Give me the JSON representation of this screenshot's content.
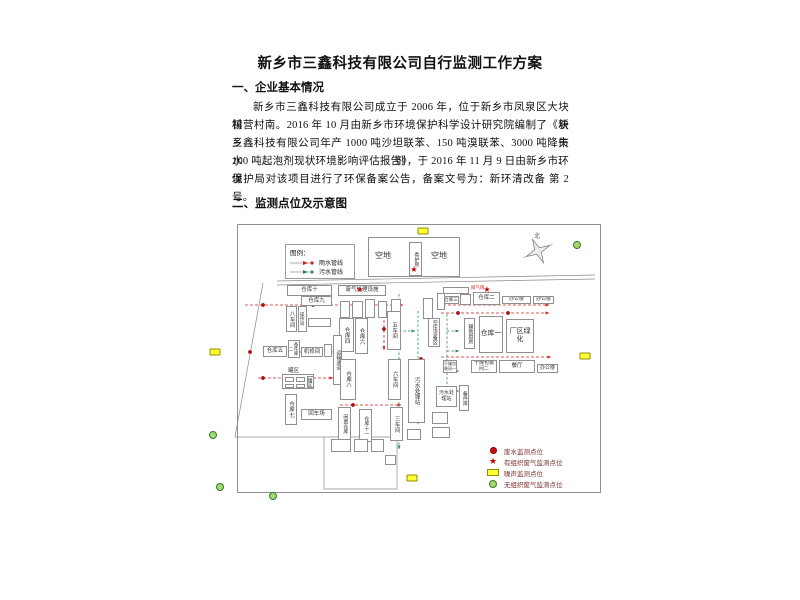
{
  "document": {
    "title": "新乡市三鑫科技有限公司自行监测工作方案",
    "section1_heading": "一、企业基本情况",
    "paragraph_lines": [
      "新乡市三鑫科技有限公司成立于 2006 年，位于新乡市凤泉区大块镇块",
      "村营村南。2016 年 10 月由新乡市环境保护科学设计研究院编制了《新乡市",
      "三鑫科技有限公司年产 1000 吨沙坦联苯、150 吨溴联苯、3000 吨降失水剂、",
      "100 吨起泡剂现状环境影响评估报告》，于 2016 年 11 月 9 日由新乡市环境",
      "保护局对该项目进行了环保备案公告，备案文号为：新环清改备 第 2 号。"
    ],
    "section2_heading": "二、监测点位及示意图"
  },
  "map": {
    "compass_label": "北",
    "star_char": "★",
    "colors": {
      "rain_line": "#cc2222",
      "sewage_line": "#2e8b57",
      "noise_fill": "#ffff33",
      "noise_border": "#8f8f00",
      "gas_fill": "#a6d96a",
      "gas_border": "#2e7d32",
      "star": "#cc0000",
      "dot": "#bb1111",
      "legend_text": "#7a2e2e"
    },
    "legend_pipes": {
      "title": "图例：",
      "items": [
        {
          "label": "雨水管线",
          "color": "#cc2222"
        },
        {
          "label": "污水管线",
          "color": "#2e8b57"
        }
      ]
    },
    "legend_points": [
      {
        "symbol": "dot",
        "label": "废水监测点位"
      },
      {
        "symbol": "star",
        "label": "有组织废气监测点位"
      },
      {
        "symbol": "noise",
        "label": "噪声监测点位"
      },
      {
        "symbol": "gas",
        "label": "无组织废气监测点位"
      }
    ],
    "buildings": [
      {
        "label": "",
        "x": 165,
        "y": 18,
        "w": 92,
        "h": 40
      },
      {
        "label": "看护房",
        "x": 206,
        "y": 23,
        "w": 13,
        "h": 34,
        "v": 1,
        "fs": 5
      },
      {
        "label": "仓库十",
        "x": 84,
        "y": 66,
        "w": 45,
        "h": 11
      },
      {
        "label": "仓库九",
        "x": 98,
        "y": 77,
        "w": 31,
        "h": 10
      },
      {
        "label": "八车间",
        "x": 83,
        "y": 87,
        "w": 11,
        "h": 26,
        "v": 1
      },
      {
        "label": "操作间",
        "x": 95,
        "y": 87,
        "w": 9,
        "h": 26,
        "v": 1,
        "fs": 4.5
      },
      {
        "label": "",
        "x": 105,
        "y": 99,
        "w": 23,
        "h": 9
      },
      {
        "label": "废气处理设施",
        "x": 135,
        "y": 66,
        "w": 48,
        "h": 11
      },
      {
        "label": "",
        "x": 240,
        "y": 68,
        "w": 26,
        "h": 7
      },
      {
        "label": "仓库三",
        "x": 240,
        "y": 77,
        "w": 16,
        "h": 8,
        "fs": 4.5
      },
      {
        "label": "",
        "x": 257,
        "y": 75,
        "w": 11,
        "h": 11
      },
      {
        "label": "仓库二",
        "x": 270,
        "y": 73,
        "w": 27,
        "h": 13
      },
      {
        "label": "办公楼",
        "x": 299,
        "y": 77,
        "w": 29,
        "h": 8,
        "fs": 5
      },
      {
        "label": "办公楼",
        "x": 330,
        "y": 77,
        "w": 21,
        "h": 8,
        "fs": 5
      },
      {
        "label": "",
        "x": 137,
        "y": 82,
        "w": 10,
        "h": 17
      },
      {
        "label": "",
        "x": 149,
        "y": 82,
        "w": 11,
        "h": 17
      },
      {
        "label": "",
        "x": 162,
        "y": 80,
        "w": 10,
        "h": 19
      },
      {
        "label": "",
        "x": 175,
        "y": 82,
        "w": 9,
        "h": 17
      },
      {
        "label": "",
        "x": 188,
        "y": 80,
        "w": 10,
        "h": 19
      },
      {
        "label": "",
        "x": 220,
        "y": 79,
        "w": 10,
        "h": 21
      },
      {
        "label": "",
        "x": 234,
        "y": 74,
        "w": 8,
        "h": 17
      },
      {
        "label": "仓库四",
        "x": 136,
        "y": 99,
        "w": 15,
        "h": 34,
        "v": 1
      },
      {
        "label": "仓库六",
        "x": 152,
        "y": 99,
        "w": 13,
        "h": 36,
        "v": 1
      },
      {
        "label": "五车间",
        "x": 184,
        "y": 92,
        "w": 14,
        "h": 39,
        "v": 1
      },
      {
        "label": "空压设备区",
        "x": 225,
        "y": 99,
        "w": 12,
        "h": 29,
        "v": 1,
        "fs": 5
      },
      {
        "label": "辅助用房",
        "x": 261,
        "y": 99,
        "w": 11,
        "h": 31,
        "v": 1,
        "fs": 5
      },
      {
        "label": "仓库一",
        "x": 276,
        "y": 97,
        "w": 24,
        "h": 37,
        "fs": 7
      },
      {
        "label": "厂区绿化",
        "x": 303,
        "y": 100,
        "w": 28,
        "h": 34,
        "fs": 7
      },
      {
        "label": "仓库五",
        "x": 60,
        "y": 127,
        "w": 24,
        "h": 11
      },
      {
        "label": "备件库二",
        "x": 85,
        "y": 121,
        "w": 12,
        "h": 18,
        "v": 1,
        "fs": 4.5
      },
      {
        "label": "机修间",
        "x": 98,
        "y": 128,
        "w": 22,
        "h": 10
      },
      {
        "label": "",
        "x": 121,
        "y": 125,
        "w": 8,
        "h": 13
      },
      {
        "label": "运输通道",
        "x": 130,
        "y": 116,
        "w": 9,
        "h": 50,
        "v": 1,
        "fs": 5
      },
      {
        "label": "",
        "x": 79,
        "y": 155,
        "w": 32,
        "h": 15
      },
      {
        "label": "",
        "x": 82,
        "y": 158,
        "w": 9,
        "h": 5
      },
      {
        "label": "",
        "x": 93,
        "y": 158,
        "w": 9,
        "h": 5
      },
      {
        "label": "",
        "x": 82,
        "y": 165,
        "w": 9,
        "h": 4
      },
      {
        "label": "",
        "x": 93,
        "y": 165,
        "w": 9,
        "h": 4
      },
      {
        "label": "罐区",
        "x": 104,
        "y": 157,
        "w": 7,
        "h": 12,
        "v": 1,
        "fs": 4.5
      },
      {
        "label": "仓库八",
        "x": 137,
        "y": 140,
        "w": 16,
        "h": 41,
        "v": 1
      },
      {
        "label": "六车间",
        "x": 185,
        "y": 140,
        "w": 13,
        "h": 41,
        "v": 1
      },
      {
        "label": "污水处理站",
        "x": 205,
        "y": 140,
        "w": 17,
        "h": 64,
        "v": 1
      },
      {
        "label": "仓库七",
        "x": 82,
        "y": 175,
        "w": 12,
        "h": 31,
        "v": 1
      },
      {
        "label": "回车场",
        "x": 98,
        "y": 190,
        "w": 31,
        "h": 11
      },
      {
        "label": "闲置仓库",
        "x": 135,
        "y": 188,
        "w": 13,
        "h": 33,
        "v": 1,
        "fs": 5
      },
      {
        "label": "仓库十一",
        "x": 156,
        "y": 190,
        "w": 13,
        "h": 33,
        "v": 1,
        "fs": 5
      },
      {
        "label": "三车间",
        "x": 187,
        "y": 188,
        "w": 13,
        "h": 34,
        "v": 1
      },
      {
        "label": "污水处理站",
        "x": 233,
        "y": 167,
        "w": 21,
        "h": 21,
        "fs": 5
      },
      {
        "label": "备件库",
        "x": 256,
        "y": 166,
        "w": 10,
        "h": 26,
        "v": 1,
        "fs": 5
      },
      {
        "label": "干燥包装间一",
        "x": 240,
        "y": 141,
        "w": 14,
        "h": 13,
        "fs": 4
      },
      {
        "label": "干燥包装间二",
        "x": 268,
        "y": 141,
        "w": 26,
        "h": 13,
        "fs": 5
      },
      {
        "label": "餐厅",
        "x": 296,
        "y": 141,
        "w": 36,
        "h": 13
      },
      {
        "label": "办公楼",
        "x": 334,
        "y": 145,
        "w": 21,
        "h": 9,
        "fs": 5
      },
      {
        "label": "",
        "x": 229,
        "y": 193,
        "w": 16,
        "h": 12
      },
      {
        "label": "",
        "x": 229,
        "y": 208,
        "w": 18,
        "h": 11
      },
      {
        "label": "",
        "x": 204,
        "y": 210,
        "w": 14,
        "h": 11
      },
      {
        "label": "",
        "x": 128,
        "y": 220,
        "w": 20,
        "h": 13
      },
      {
        "label": "",
        "x": 151,
        "y": 220,
        "w": 14,
        "h": 13
      },
      {
        "label": "",
        "x": 168,
        "y": 220,
        "w": 13,
        "h": 13
      },
      {
        "label": "",
        "x": 182,
        "y": 236,
        "w": 11,
        "h": 10
      }
    ],
    "texts": [
      {
        "t": "空地",
        "x": 172,
        "y": 31,
        "size": 8
      },
      {
        "t": "空地",
        "x": 228,
        "y": 31,
        "size": 8
      },
      {
        "t": "罐区",
        "x": 85,
        "y": 147,
        "size": 5.5
      },
      {
        "t": "排气筒",
        "x": 268,
        "y": 66,
        "size": 4.5,
        "color": "#cc2222"
      }
    ],
    "points": {
      "stars": [
        [
          157,
          71
        ],
        [
          211,
          51
        ],
        [
          284,
          71
        ]
      ],
      "dots": [
        [
          60,
          86
        ],
        [
          110,
          86
        ],
        [
          155,
          86
        ],
        [
          47,
          133
        ],
        [
          60,
          159
        ],
        [
          150,
          186
        ],
        [
          255,
          94
        ],
        [
          305,
          94
        ],
        [
          181,
          110
        ],
        [
          196,
          125
        ],
        [
          218,
          140
        ]
      ],
      "noise": [
        [
          220,
          12
        ],
        [
          12,
          133
        ],
        [
          382,
          137
        ],
        [
          209,
          259
        ]
      ],
      "gas": [
        [
          374,
          26
        ],
        [
          10,
          216
        ],
        [
          17,
          268
        ],
        [
          70,
          277
        ]
      ]
    },
    "pipes": {
      "rain": [
        "M42,86 H200",
        "M240,86 H346",
        "M96,133 H130",
        "M181,91 V131",
        "M55,159 H130",
        "M137,186 H198",
        "M238,94 H346",
        "M238,138 H348"
      ],
      "sewage": [
        "M196,75 V230",
        "M215,92 V205",
        "M244,95 V185",
        "M196,112 H212",
        "M244,112 H256",
        "M244,132 H256",
        "M244,152 H256",
        "M244,172 H256"
      ],
      "boundary": [
        "M60,64 L32,218",
        "M32,218 H121",
        "M121,218 H194 V270 H121 Z",
        "M74,62 L392,56",
        "M74,66 L392,60"
      ]
    }
  }
}
